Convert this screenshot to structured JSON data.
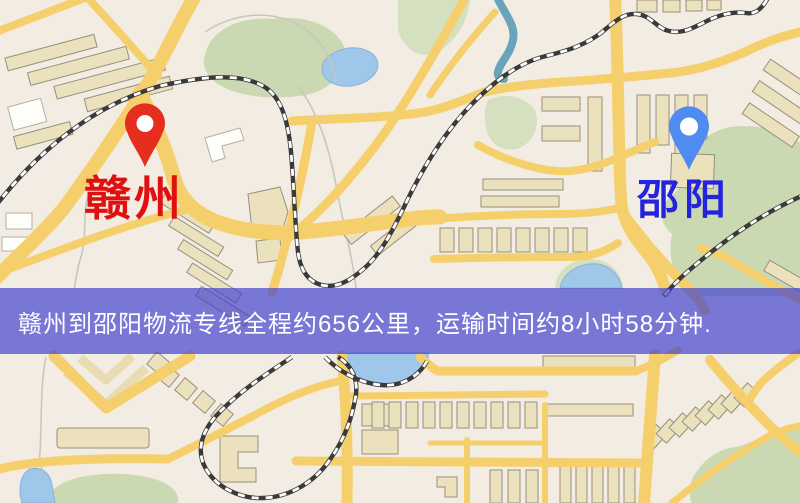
{
  "banner": {
    "text": "赣州到邵阳物流专线全程约656公里，运输时间约8小时58分钟.",
    "bg_color": "#3a3ad0",
    "text_color": "#ffffff"
  },
  "route": {
    "origin": "赣州",
    "destination": "邵阳",
    "distance_km": "656",
    "duration": "8小时58分钟"
  },
  "markers": {
    "origin": {
      "label": "赣州",
      "label_color": "#e11010",
      "pin_color": "#e62e1f"
    },
    "destination": {
      "label": "邵阳",
      "label_color": "#2424dd",
      "pin_color": "#4f8bf0"
    }
  },
  "map_colors": {
    "background": "#f3ece2",
    "road": "#f6cf6d",
    "water": "#9ec7ea",
    "river": "#6aa4bc",
    "park_green": "#cbd9b3",
    "building": "#ece1bd",
    "railway_dark": "#3a3a3a",
    "railway_light": "#ffffff"
  }
}
